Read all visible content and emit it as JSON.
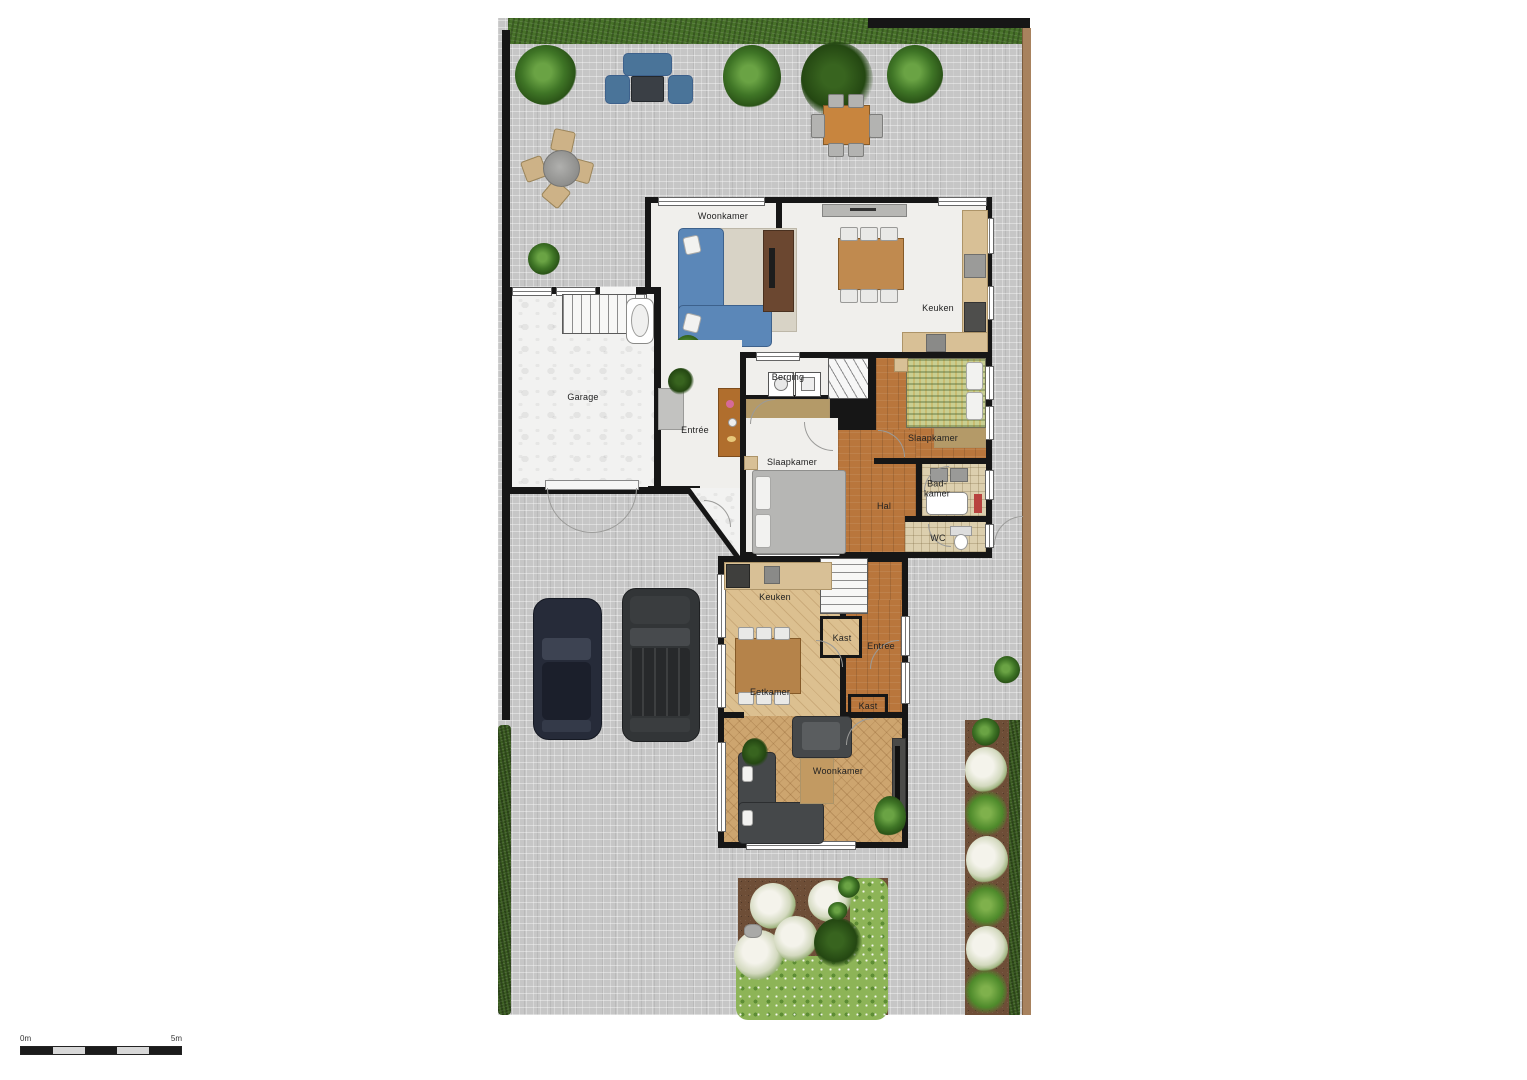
{
  "rooms": {
    "woonkamer_upper": "Woonkamer",
    "keuken_upper": "Keuken",
    "garage": "Garage",
    "entree_upper": "Entrée",
    "berging": "Berging",
    "slaapkamer_right": "Slaapkamer",
    "slaapkamer_left": "Slaapkamer",
    "hal": "Hal",
    "badkamer_line1": "Bad-",
    "badkamer_line2": "kamer",
    "wc": "WC",
    "keuken_lower": "Keuken",
    "kast_upper": "Kast",
    "entree_lower": "Entree",
    "eetkamer": "Eetkamer",
    "kast_lower": "Kast",
    "woonkamer_lower": "Woonkamer"
  },
  "scale_bar": {
    "start": "0m",
    "end": "5m"
  },
  "colors": {
    "wall": "#161616",
    "paving": "#c6c6c6",
    "grass": "#477129",
    "soil": "#6e4e37",
    "wood_dark": "#b9763c",
    "wood_light": "#dcc090",
    "sofa_blue": "#5b87b8",
    "sofa_dark": "#45484a"
  }
}
